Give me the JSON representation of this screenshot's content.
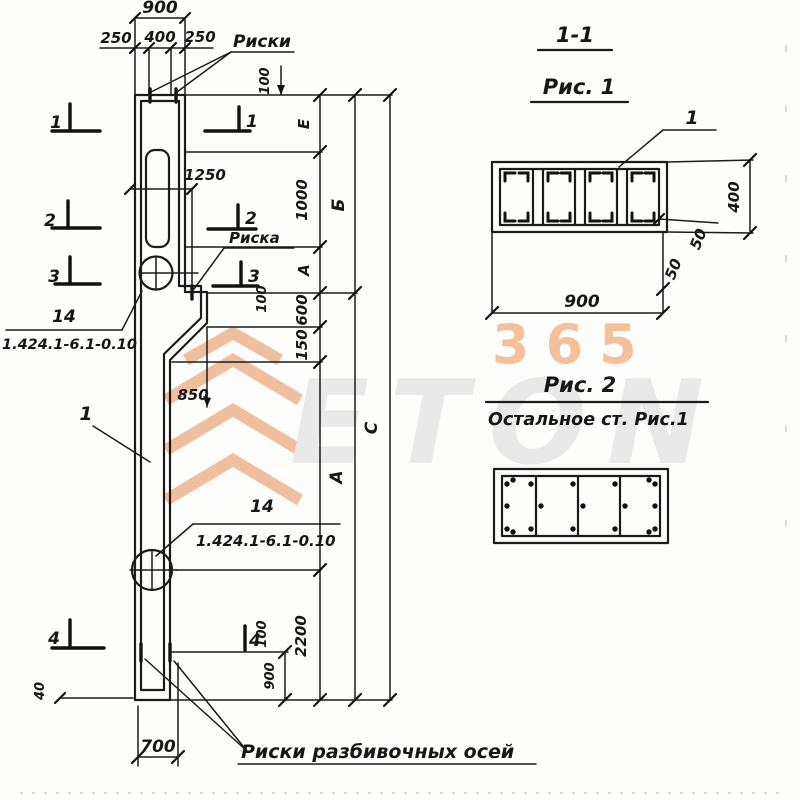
{
  "drawing": {
    "watermark": {
      "brand": "ETON",
      "digits": "365"
    },
    "titles": {
      "section": "1-1",
      "fig1": "Рис. 1",
      "fig2": "Рис. 2",
      "fig2_note": "Остальное ст. Рис.1"
    },
    "labels": {
      "riski_top": "Риски",
      "riska_mid": "Риска",
      "riski_axes": "Риски разбивочных осей"
    },
    "callouts": {
      "part": "1",
      "fig1_bar": "1",
      "loop_top_num": "14",
      "loop_top_series": "1.424.1-6.1-0.10",
      "loop_bottom_num": "14",
      "loop_bottom_series": "1.424.1-6.1-0.10"
    },
    "markers": [
      "1",
      "2",
      "3",
      "4"
    ],
    "dims": {
      "total_width": "900",
      "seg_left": "250",
      "seg_mid": "400",
      "seg_right": "250",
      "top_offset": "100",
      "slot_offset": "1250",
      "chain_e": "Е",
      "chain_1000": "1000",
      "chain_a": "А",
      "chain_600": "600",
      "chain_150": "150",
      "chain_2200": "2200",
      "chain_b": "Б",
      "chain_a2": "А",
      "chain_c": "С",
      "m3_offset": "100",
      "m4_offset": "100",
      "bend": "850",
      "bottom_900": "900",
      "bottom_700": "700",
      "bottom_40": "40"
    },
    "fig1_dims": {
      "width": "900",
      "height": "400",
      "cover_a": "50",
      "cover_b": "50"
    }
  }
}
